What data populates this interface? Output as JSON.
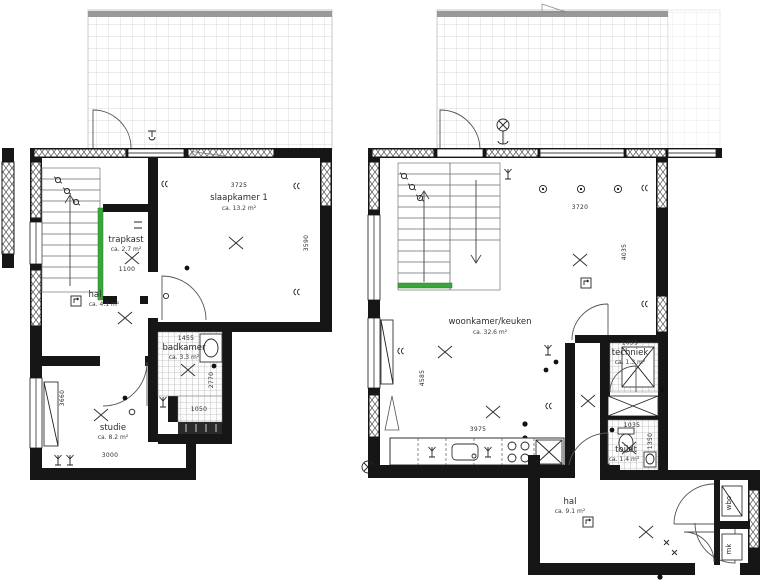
{
  "document_type": "floor plans",
  "colors": {
    "wall": "#161616",
    "stair_accent": "#3ba43b",
    "terrace_bar": "#999999",
    "tile_line": "#9a9a9a",
    "grid_line": "#cccccc"
  },
  "left_plan": {
    "rooms": {
      "slaapkamer": {
        "name": "slaapkamer 1",
        "area": "ca. 13.2 m²"
      },
      "trapkast": {
        "name": "trapkast",
        "area": "ca. 2.7 m²"
      },
      "hal": {
        "name": "hal",
        "area": "ca. 4.1 m²"
      },
      "badkamer": {
        "name": "badkamer",
        "area": "ca. 3.3 m²"
      },
      "studie": {
        "name": "studie",
        "area": "ca. 8.2 m²"
      }
    },
    "dimensions": {
      "slaapkamer_width": "3725",
      "slaapkamer_height": "3590",
      "trapkast_door": "1100",
      "badkamer_width": "1455",
      "badkamer_height": "2770",
      "washer_niche_width": "1050",
      "studie_height": "3660",
      "studie_width": "3000"
    }
  },
  "right_plan": {
    "rooms": {
      "woonkamer": {
        "name": "woonkamer/keuken",
        "area": "ca. 32.6 m²"
      },
      "techniek": {
        "name": "techniek",
        "area": "ca. 1.3 m²"
      },
      "toilet": {
        "name": "toilet",
        "area": "ca. 1.4 m²"
      },
      "hal": {
        "name": "hal",
        "area": "ca. 9.1 m²"
      },
      "closet_top": {
        "name": "wbo"
      },
      "closet_bottom": {
        "name": "mk"
      }
    },
    "dimensions": {
      "woonkamer_width": "3720",
      "woonkamer_height_right": "4035",
      "woonkamer_height_left": "4585",
      "kitchen_width": "3975",
      "techniek_width": "1035",
      "toilet_width": "1035",
      "toilet_height": "1350"
    }
  }
}
